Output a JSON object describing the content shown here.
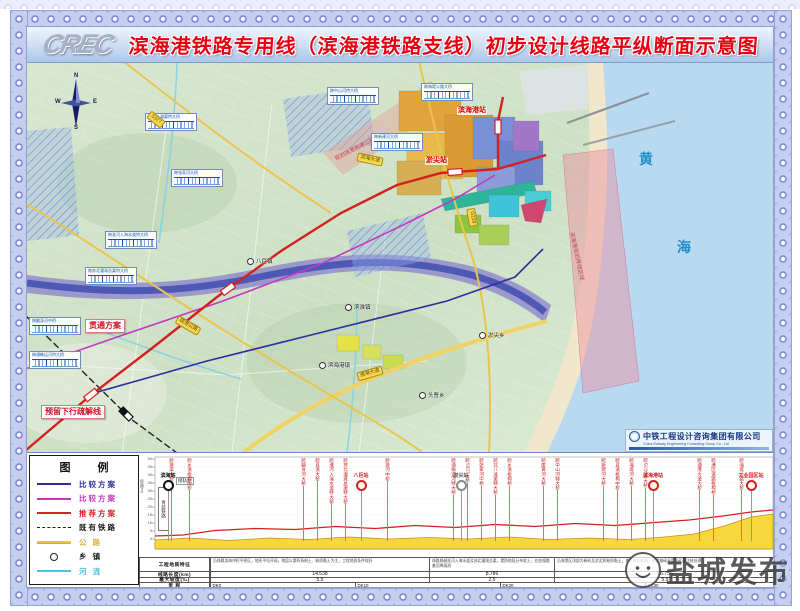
{
  "colors": {
    "title_red": "#e60012",
    "line_red": "#d42020",
    "line_magenta": "#c23ac2",
    "line_navy": "#2e2e9e",
    "road_yellow": "#eec84e",
    "river_blue": "#4a55b4",
    "sea": "#b9d9f0",
    "sand": "#f0e7cd",
    "land": "#d3e3cb"
  },
  "header": {
    "logo": "CREC",
    "title": "滨海港铁路专用线（滨海港铁路支线）初步设计线路平纵断面示意图"
  },
  "map": {
    "sea_chars": [
      "黄",
      "海"
    ],
    "compass": {
      "n": "N",
      "s": "S",
      "w": "W",
      "e": "E"
    },
    "plan_labels": [
      {
        "text": "贯通方案",
        "x": 58,
        "y": 256
      },
      {
        "text": "预留下行疏解线",
        "x": 14,
        "y": 342
      }
    ],
    "station_labels": [
      {
        "text": "淤尖站",
        "x": 398,
        "y": 94
      },
      {
        "text": "滨海港站",
        "x": 430,
        "y": 44
      }
    ],
    "shore_label": {
      "text": "滨海港规划岸线区域",
      "x": 549,
      "y": 168,
      "rot": 78
    },
    "hw_label": {
      "text": "规划疏港高速公路",
      "x": 306,
      "y": 92,
      "rot": -27
    },
    "bridge_boxes": [
      {
        "name": "跨北八滩渠特大桥",
        "x": 118,
        "y": 50
      },
      {
        "name": "跨张家河大桥",
        "x": 144,
        "y": 106
      },
      {
        "name": "跨淮河入海水道特大桥",
        "x": 78,
        "y": 168
      },
      {
        "name": "跨苏北灌溉总渠特大桥",
        "x": 58,
        "y": 204
      },
      {
        "name": "跨翻身河中桥",
        "x": 2,
        "y": 254
      },
      {
        "name": "跨通榆运河特大桥",
        "x": 2,
        "y": 288
      },
      {
        "name": "跨中山河特大桥",
        "x": 300,
        "y": 24
      },
      {
        "name": "跨新建河大桥",
        "x": 344,
        "y": 70
      },
      {
        "name": "跨海堤公路大桥",
        "x": 394,
        "y": 20
      }
    ],
    "road_labels": [
      {
        "text": "G228",
        "x": 436,
        "y": 150,
        "rot": 80
      },
      {
        "text": "滨海大道",
        "x": 330,
        "y": 92,
        "rot": 12
      },
      {
        "text": "通港大道",
        "x": 330,
        "y": 306,
        "rot": -16
      },
      {
        "text": "S327",
        "x": 120,
        "y": 52,
        "rot": 38
      },
      {
        "text": "疏港公路",
        "x": 148,
        "y": 258,
        "rot": 30
      }
    ],
    "towns": [
      {
        "name": "八巨镇",
        "x": 220,
        "y": 194
      },
      {
        "name": "滨淮镇",
        "x": 318,
        "y": 240
      },
      {
        "name": "淤尖乡",
        "x": 452,
        "y": 268
      },
      {
        "name": "滨海港镇",
        "x": 292,
        "y": 298
      },
      {
        "name": "头罾乡",
        "x": 392,
        "y": 328
      }
    ],
    "company": {
      "name": "中铁工程设计咨询集团有限公司",
      "en": "China Railway Engineering Consulting Group Co., Ltd"
    }
  },
  "legend": {
    "title": "图 例",
    "items": [
      {
        "label": "比较方案",
        "color": "#2e2e9e",
        "type": "solid"
      },
      {
        "label": "比较方案",
        "color": "#c23ac2",
        "type": "solid"
      },
      {
        "label": "推荐方案",
        "color": "#d22424",
        "type": "solid"
      },
      {
        "label": "既有铁路",
        "color": "#1a1a1a",
        "type": "dashed"
      },
      {
        "label": "公  路",
        "color": "#d8b23c",
        "type": "road"
      },
      {
        "label": "乡  镇",
        "color": "#1a1a1a",
        "type": "circle"
      },
      {
        "label": "河  流",
        "color": "#4ec2e0",
        "type": "river"
      }
    ]
  },
  "profile": {
    "axis_label": "标高(m)",
    "axis_box": "青盐铁路",
    "junction_note": "接轨站",
    "yticks": [
      {
        "t": "50",
        "y": 3
      },
      {
        "t": "45",
        "y": 11
      },
      {
        "t": "40",
        "y": 19
      },
      {
        "t": "35",
        "y": 27
      },
      {
        "t": "30",
        "y": 35
      },
      {
        "t": "25",
        "y": 43
      },
      {
        "t": "20",
        "y": 51
      },
      {
        "t": "15",
        "y": 59
      },
      {
        "t": "10",
        "y": 67
      },
      {
        "t": "5",
        "y": 75
      },
      {
        "t": "0",
        "y": 83
      }
    ],
    "bridges": [
      {
        "name": "跨排渠中桥",
        "x": 32
      },
      {
        "name": "跨乡道框构中桥",
        "x": 50
      },
      {
        "name": "跨翻身河大桥",
        "x": 164
      },
      {
        "name": "跨县道大桥",
        "x": 178
      },
      {
        "name": "跨淮河入海水道特大桥",
        "x": 192
      },
      {
        "name": "跨苏北灌溉总渠特大桥",
        "x": 206
      },
      {
        "name": "跨排河中桥",
        "x": 248
      },
      {
        "name": "跨通榆运河特大桥",
        "x": 314
      },
      {
        "name": "跨S327大桥",
        "x": 328
      },
      {
        "name": "跨张家河中桥",
        "x": 342
      },
      {
        "name": "跨北八滩渠特大桥",
        "x": 356
      },
      {
        "name": "跨乡道框构桥",
        "x": 370
      },
      {
        "name": "跨废黄河大桥",
        "x": 404
      },
      {
        "name": "跨中山河特大桥",
        "x": 418
      },
      {
        "name": "跨新建河大桥",
        "x": 464
      },
      {
        "name": "跨县道框构中桥",
        "x": 478
      },
      {
        "name": "跨海堤河大桥",
        "x": 492
      },
      {
        "name": "跨G228特大桥",
        "x": 506
      },
      {
        "name": "跨通港大道大桥",
        "x": 560
      },
      {
        "name": "跨港区道路框构桥",
        "x": 574
      },
      {
        "name": "跨海堤公路大桥",
        "x": 602
      }
    ],
    "stations": [
      {
        "name": "滨海站",
        "x": 29,
        "cls": "black"
      },
      {
        "name": "八巨站",
        "x": 222,
        "cls": "red"
      },
      {
        "name": "淤尖站",
        "x": 322,
        "cls": "gray"
      },
      {
        "name": "滨海港站",
        "x": 514,
        "cls": "red"
      },
      {
        "name": "工业园区站",
        "x": 612,
        "cls": "red"
      }
    ]
  },
  "table": {
    "row_labels": {
      "geo": "工程地质特征",
      "len": "线路长度(km)",
      "grade": "最大坡度(‰)",
      "mile": "里  程"
    },
    "geo_cells": [
      {
        "x": 70,
        "w": 219,
        "text": "沿线属滨海冲积平原区，地形平坦开阔，地层以第四系粉土、粉质黏土为主，工程地质条件较好"
      },
      {
        "x": 289,
        "w": 125,
        "text": "线路跨越淮河入海水道及苏北灌溉总渠，堤防地段分布软土，应加强路基沉降观测"
      },
      {
        "x": 414,
        "w": 221,
        "text": "沿海垦区浅部为粉砂及淤泥质粉质黏土，地下水位较高，桥梁基础采用钻孔灌注桩处理"
      }
    ],
    "len_cells": [
      {
        "x": 70,
        "w": 219,
        "text": "14.538"
      },
      {
        "x": 289,
        "w": 125,
        "text": "8.786"
      },
      {
        "x": 414,
        "w": 221,
        "text": "16.756"
      }
    ],
    "grade_cells": [
      {
        "x": 70,
        "w": 219,
        "text": "5.5"
      },
      {
        "x": 289,
        "w": 125,
        "text": "2.5"
      },
      {
        "x": 414,
        "w": 221,
        "text": "5.9"
      }
    ],
    "mileage": [
      {
        "x": 70,
        "text": "DK0"
      },
      {
        "x": 215,
        "text": "DK10"
      },
      {
        "x": 360,
        "text": "DK20"
      },
      {
        "x": 505,
        "text": "DK30"
      }
    ]
  },
  "watermark": {
    "text": "盐城发布"
  }
}
